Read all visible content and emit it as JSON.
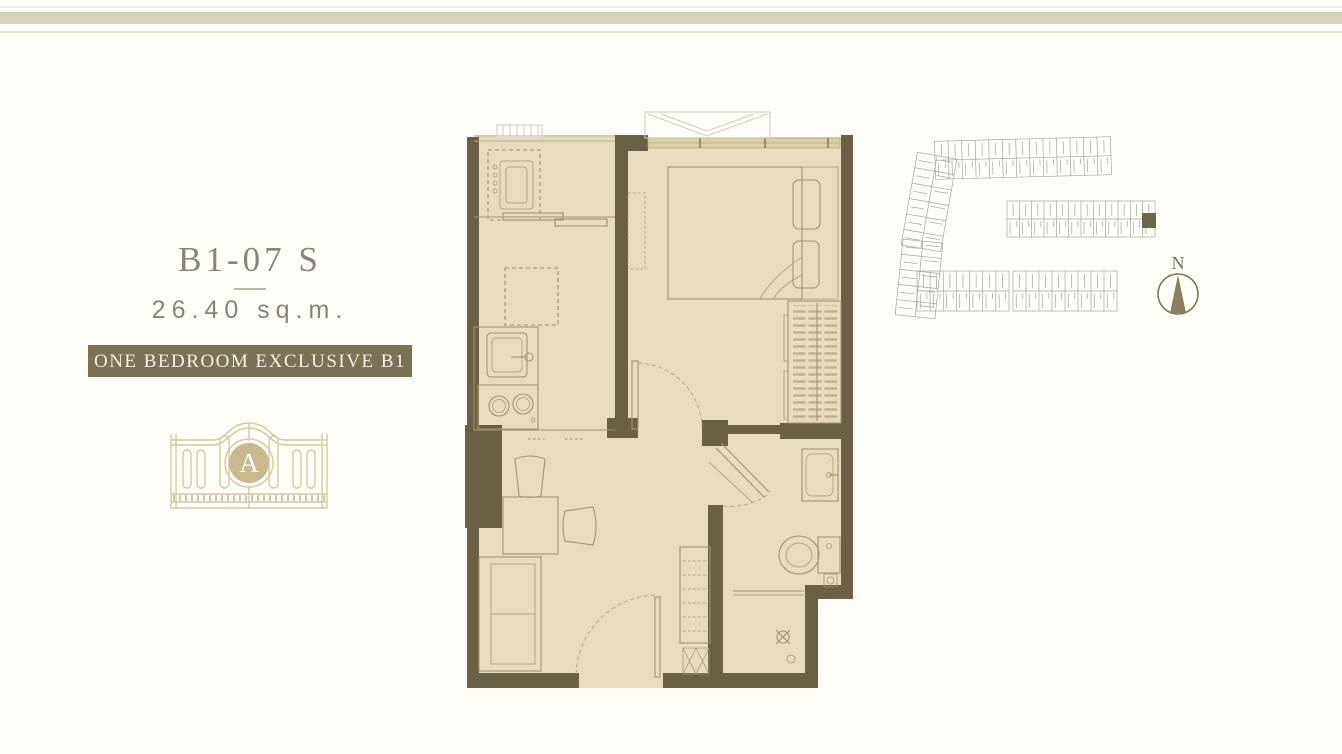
{
  "unit": {
    "code": "B1-07 S",
    "area": "26.40 sq.m.",
    "type_label": "ONE BEDROOM EXCLUSIVE B1"
  },
  "logo": {
    "monogram": "A"
  },
  "compass": {
    "north_label": "N"
  },
  "colors": {
    "background": "#fffdf7",
    "top_band": "#d8d1bb",
    "hairline": "#e7e4d6",
    "title_text": "#8a8376",
    "badge_bg": "#7a7254",
    "badge_text": "#f5f1e3",
    "wall": "#6a6144",
    "floor": "#e7dcbe",
    "furniture_line": "#a2936a",
    "window_band": "#d9cfa8",
    "light_line": "#cfccc1",
    "gate": "#d5c7a1",
    "gate_circle": "#c8b98e",
    "site_line": "#a5a4a0",
    "site_highlight": "#6c6550",
    "compass": "#7c7458"
  }
}
